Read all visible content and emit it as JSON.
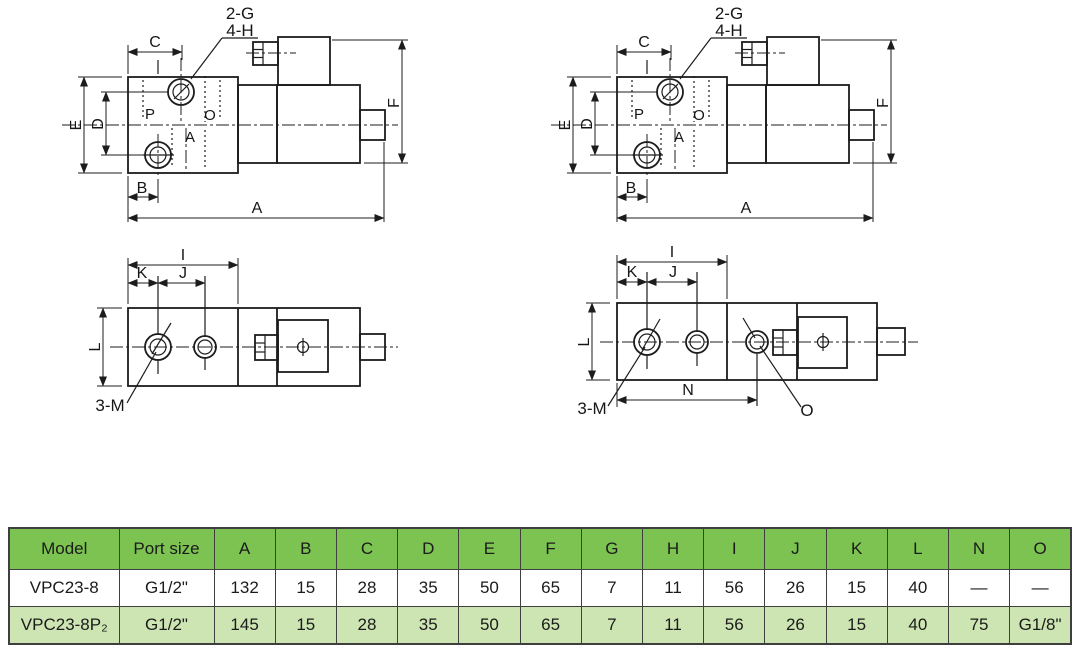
{
  "page": {
    "background": "#ffffff"
  },
  "drawings": {
    "side_view": {
      "callout_line1": "2-G",
      "callout_line2": "4-H",
      "dim_a": "A",
      "dim_b": "B",
      "dim_c": "C",
      "dim_d": "D",
      "dim_e": "E",
      "dim_f": "F",
      "port_p": "P",
      "port_o": "O",
      "port_a": "A"
    },
    "top_view_left": {
      "dim_i": "I",
      "dim_j": "J",
      "dim_k": "K",
      "dim_l": "L",
      "callout_m": "3-M"
    },
    "top_view_right": {
      "dim_i": "I",
      "dim_j": "J",
      "dim_k": "K",
      "dim_l": "L",
      "dim_n": "N",
      "callout_m": "3-M",
      "callout_o": "O"
    }
  },
  "table": {
    "headers": [
      "Model",
      "Port size",
      "A",
      "B",
      "C",
      "D",
      "E",
      "F",
      "G",
      "H",
      "I",
      "J",
      "K",
      "L",
      "N",
      "O"
    ],
    "rows": [
      [
        "VPC23-8",
        "G1/2\"",
        "132",
        "15",
        "28",
        "35",
        "50",
        "65",
        "7",
        "11",
        "56",
        "26",
        "15",
        "40",
        "—",
        "—"
      ],
      [
        "VPC23-8P₂",
        "G1/2\"",
        "145",
        "15",
        "28",
        "35",
        "50",
        "65",
        "7",
        "11",
        "56",
        "26",
        "15",
        "40",
        "75",
        "G1/8\""
      ]
    ],
    "colors": {
      "header_bg": "#7cc351",
      "alt_row_bg": "#cde5b2",
      "border": "#3f3f3f",
      "text": "#1b1b1b"
    }
  }
}
